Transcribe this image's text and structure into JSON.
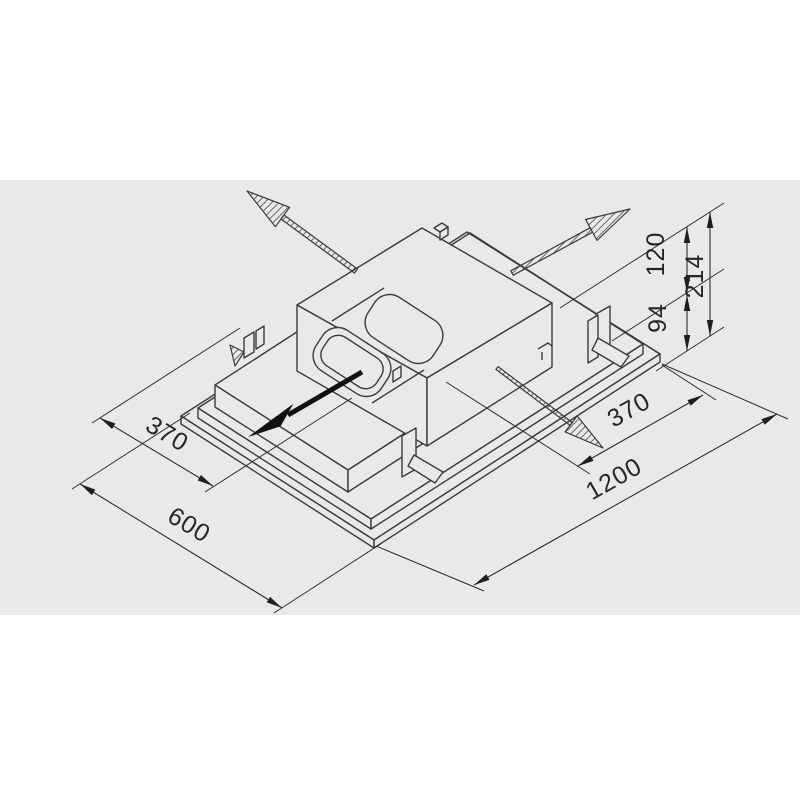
{
  "title": "Isometric dimensioned drawing of a ceiling-mounted extractor unit",
  "canvas": {
    "page_bg": "#ffffff",
    "stage_bg": "#e9e9e9",
    "line_color": "#3b3b3b",
    "text_color": "#262626"
  },
  "dimensions": {
    "d370_left": "370",
    "d600": "600",
    "d1200": "1200",
    "d370_right": "370",
    "d120": "120",
    "d214": "214",
    "d94": "94"
  },
  "airflow": {
    "exhaust_left": "air outlet top left",
    "exhaust_right": "air outlet top right",
    "intake": "air intake",
    "duct_flow": "airflow through flat duct"
  }
}
